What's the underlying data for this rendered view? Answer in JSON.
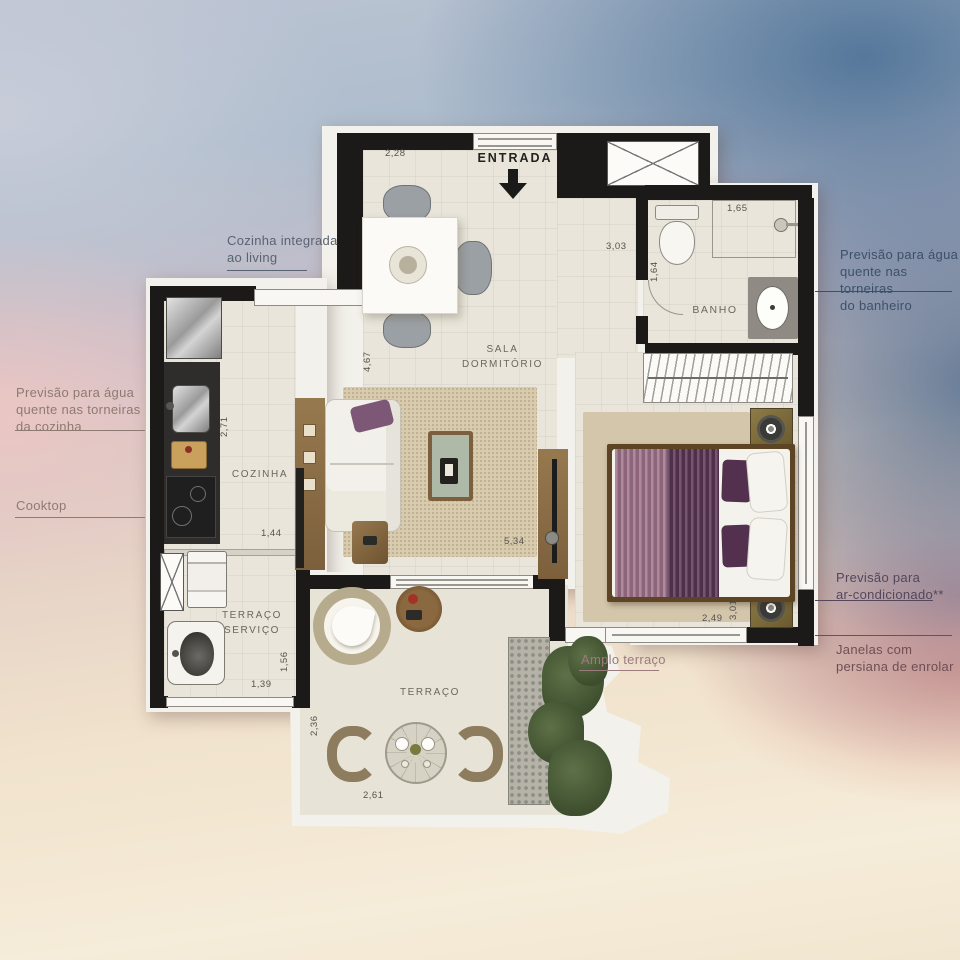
{
  "annotations": {
    "cozinha_integrada": {
      "lines": [
        "Cozinha integrada",
        "ao living"
      ]
    },
    "agua_cozinha": {
      "lines": [
        "Previsão para água",
        "quente nas torneiras",
        "da cozinha"
      ]
    },
    "cooktop": {
      "lines": [
        "Cooktop"
      ]
    },
    "agua_banheiro": {
      "lines": [
        "Previsão para água",
        "quente nas torneiras",
        "do banheiro"
      ]
    },
    "ar_condicionado": {
      "lines": [
        "Previsão para",
        "ar-condicionado**"
      ]
    },
    "janelas": {
      "lines": [
        "Janelas com",
        "persiana de enrolar"
      ]
    },
    "amplo_terraco": {
      "lines": [
        "Amplo terraço"
      ]
    }
  },
  "rooms": {
    "entrada": "ENTRADA",
    "banho": "BANHO",
    "sala": {
      "lines": [
        "SALA",
        "DORMITÓRIO"
      ]
    },
    "cozinha": "COZINHA",
    "terraco_servico": {
      "lines": [
        "TERRAÇO",
        "SERVIÇO"
      ]
    },
    "terraco": "TERRAÇO"
  },
  "dimensions": {
    "top_living": "2,28",
    "shower": "1,65",
    "hall_h": "3,03",
    "hall_v": "1,64",
    "living_v": "4,67",
    "kitchen_v": "2,71",
    "kitchen_w": "1,44",
    "living_w": "5,34",
    "bedroom_v": "3,01",
    "bedroom_w": "2,49",
    "servico_v": "1,56",
    "servico_w": "1,39",
    "terraco_v": "2,36",
    "terraco_w": "2,61"
  },
  "colors": {
    "wall": "#1b1a18",
    "floor": "#e9e5da",
    "frame_white": "#f3f1eb",
    "rug": "#d8cbae",
    "wood": "#8a6f4c",
    "bed_purple_dark": "#5e3a59",
    "bed_purple_light": "#9b7186",
    "bg_blue": "#5a7fa3",
    "bg_pink": "#eccfcc",
    "bg_cream": "#f3e7d2",
    "annotation_blue_text": "#3c5067",
    "annotation_pink_text": "#8d7b72"
  },
  "icons": {
    "entrance_arrow": "down-arrow",
    "shaft_cross": "x-cross"
  }
}
